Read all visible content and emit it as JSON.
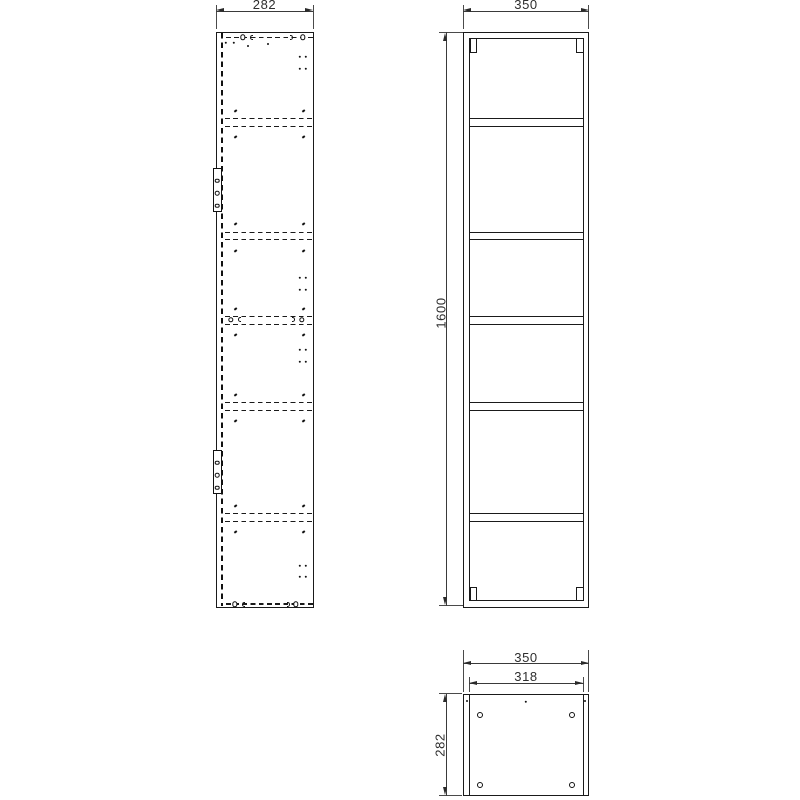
{
  "style": {
    "background": "#ffffff",
    "object_line_color": "#1a1a1a",
    "dimension_line_color": "#3a3a3a",
    "text_color": "#2e2e2e"
  },
  "views": {
    "side": {
      "dim_width": "282",
      "hinge_count": 2,
      "hidden_shelf_rows": 5
    },
    "front": {
      "dim_width": "350",
      "dim_height": "1600",
      "shelf_count": 5,
      "compartment_count": 6
    },
    "plan": {
      "dim_outer_width": "350",
      "dim_inner_width": "318",
      "dim_depth": "282",
      "hole_count": 4
    }
  }
}
